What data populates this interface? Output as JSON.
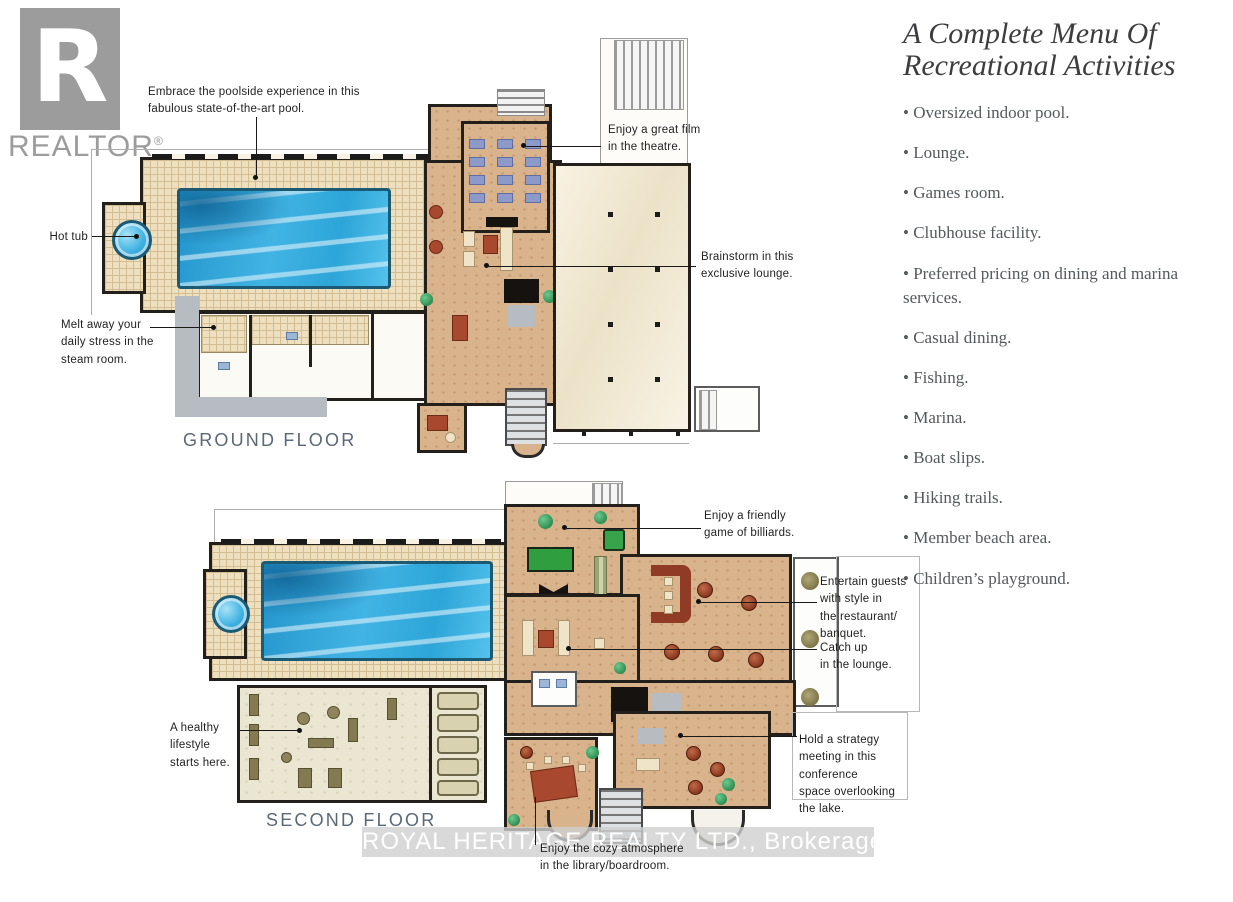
{
  "logo": {
    "letter": "R",
    "brand": "REALTOR",
    "registered": "®"
  },
  "menu": {
    "title": "A Complete Menu Of\nRecreational Activities",
    "items": [
      "Oversized indoor pool.",
      "Lounge.",
      "Games room.",
      "Clubhouse facility.",
      "Preferred pricing on dining and marina services.",
      "Casual dining.",
      "Fishing.",
      "Marina.",
      "Boat slips.",
      "Hiking trails.",
      "Member beach area.",
      "Children’s playground."
    ]
  },
  "ground_floor": {
    "label": "GROUND FLOOR",
    "notes": {
      "pool": "Embrace the poolside experience in this\nfabulous state-of-the-art pool.",
      "theatre": "Enjoy a great film\nin the theatre.",
      "hot_tub": "Hot tub",
      "lounge": "Brainstorm in this\nexclusive lounge.",
      "steam_room": "Melt away your\ndaily stress in the\nsteam room."
    }
  },
  "second_floor": {
    "label": "SECOND FLOOR",
    "notes": {
      "billiards": "Enjoy a friendly\ngame of billiards.",
      "restaurant": "Entertain guests\nwith style in\nthe restaurant/\nbanquet.",
      "lounge": "Catch up\nin the lounge.",
      "gym": "A healthy\nlifestyle\nstarts here.",
      "conference": "Hold a strategy\nmeeting in this\nconference\nspace overlooking\nthe lake.",
      "library": "Enjoy the cozy atmosphere\nin the library/boardroom."
    }
  },
  "watermark": {
    "text": "ROYAL HERITAGE REALTY LTD., Brokerage"
  },
  "colors": {
    "pool_blue": "#2fa8dc",
    "tile": "#eee0bf",
    "tan_floor": "#d8b38c",
    "deck": "#f3ecd9",
    "wall": "#23201b",
    "billiard_green": "#2f9e3f",
    "bar_burgundy": "#8f3b26",
    "logo_gray": "#9c9c9c",
    "floor_label_gray": "#5b6877",
    "menu_text_gray": "#55585c"
  }
}
